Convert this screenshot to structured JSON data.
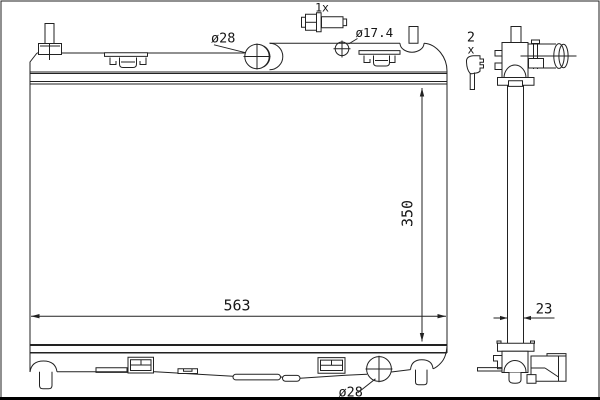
{
  "drawing": {
    "dimensions": {
      "width": "563",
      "height": "350",
      "depth": "23"
    },
    "labels": {
      "inlet_top": "ø28",
      "thread": "ø17.4",
      "outlet_bottom": "ø28",
      "drain_qty": "1x",
      "clip_qty_num": "2",
      "clip_qty_x": "x"
    },
    "icons": {
      "drain_plug": "drain-plug-screw-icon",
      "clip": "mounting-clip-icon"
    },
    "colors": {
      "line": "#222222",
      "background": "#ffffff",
      "border": "#000000"
    }
  }
}
